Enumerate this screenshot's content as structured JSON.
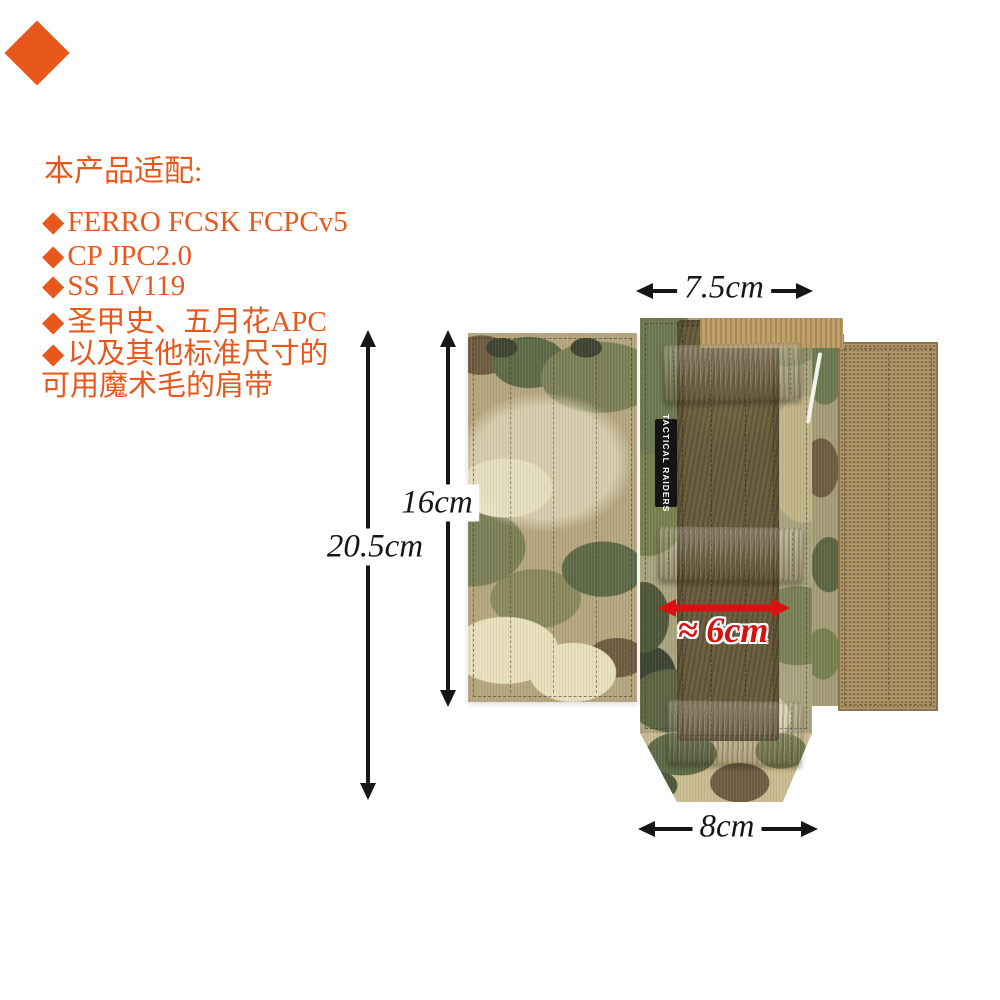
{
  "corner_badge": {
    "shape": "diamond",
    "color": "#e8571c"
  },
  "intro": {
    "heading": "本产品适配:",
    "text_color": "#e8581a",
    "lines": [
      {
        "bullet": "◆",
        "text": "FERRO FCSK FCPCv5"
      },
      {
        "bullet": "◆",
        "text": "CP JPC2.0"
      },
      {
        "bullet": "◆",
        "text": "SS LV119"
      },
      {
        "bullet": "◆",
        "text": "圣甲史、五月花APC"
      },
      {
        "bullet": "◆",
        "text": "以及其他标准尺寸的"
      },
      {
        "bullet": "",
        "text": "可用魔术毛的肩带"
      }
    ]
  },
  "dimensions": {
    "top_width": "7.5cm",
    "pad_height": "16cm",
    "total_height": "20.5cm",
    "velcro_width": "≈ 6cm",
    "bottom_width": "8cm",
    "arrow_color": "#161616",
    "highlight_color": "#dc1010"
  },
  "product": {
    "brand_label": "TACTICAL RAIDERS",
    "colors": {
      "camo_base": "#b5a67e",
      "strap_tan": "#c19a5e",
      "loop_strip_olive": "#6e6141",
      "hook_panel_coyote": "#a98e61"
    }
  }
}
